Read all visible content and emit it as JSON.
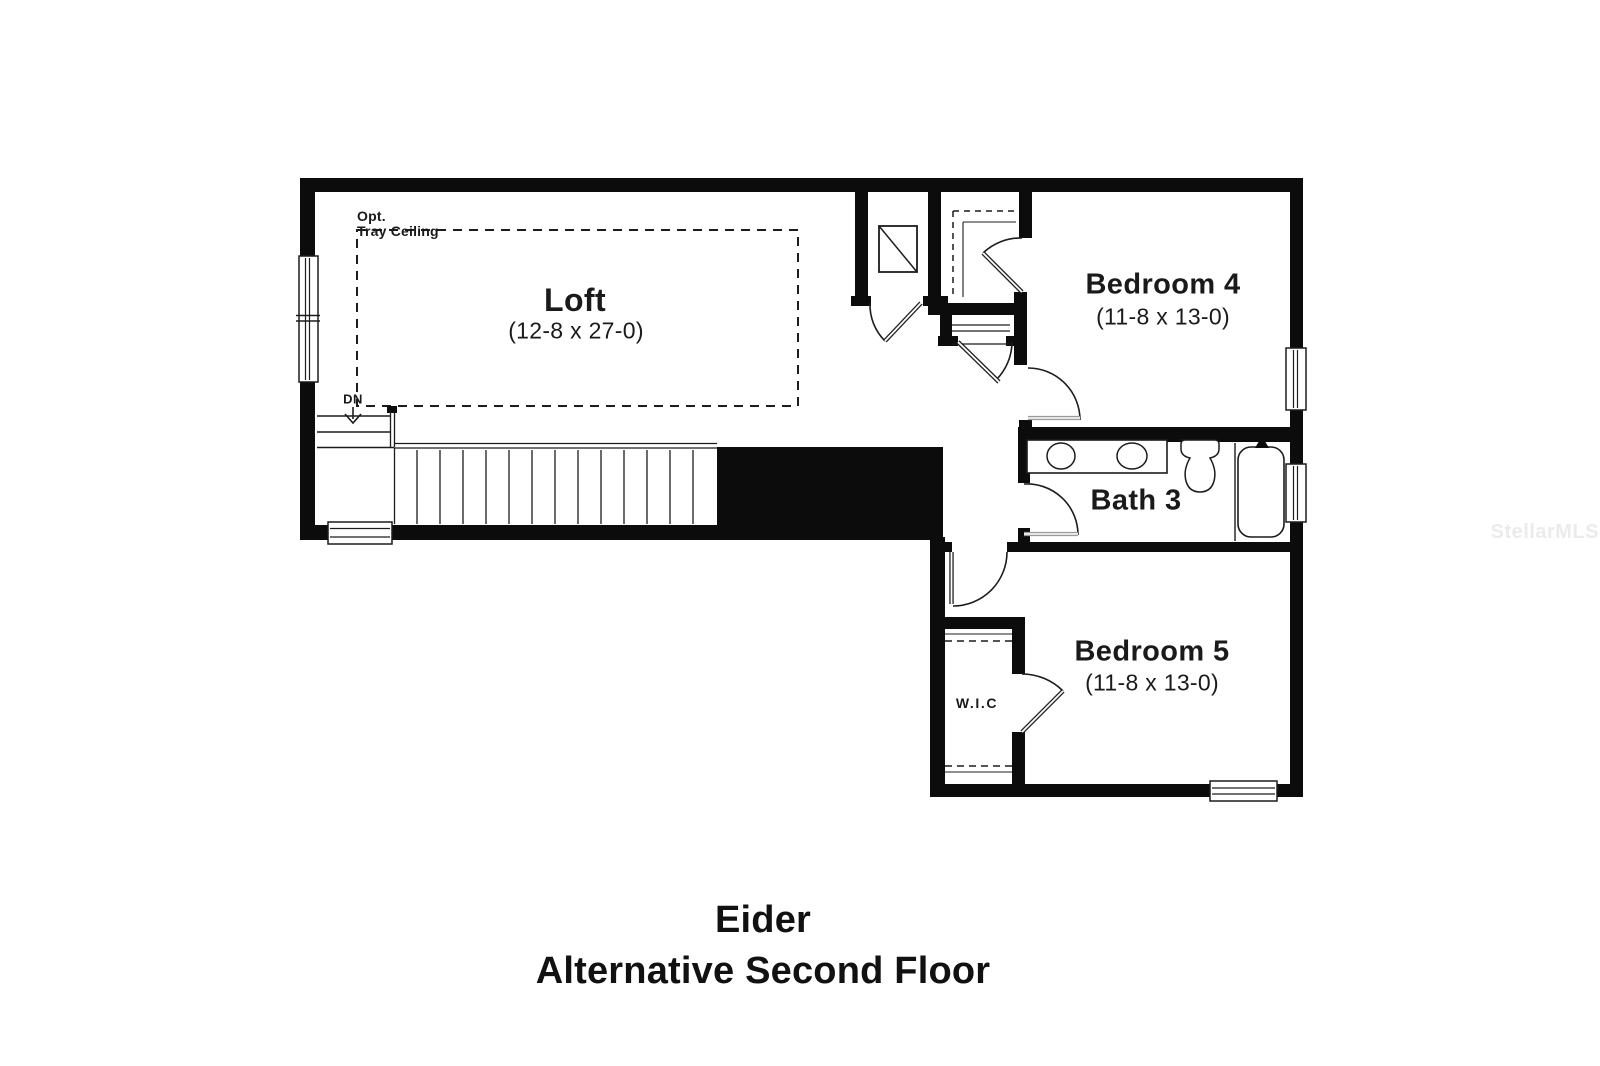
{
  "floor_plan": {
    "title": {
      "line1": "Eider",
      "line2": "Alternative Second Floor"
    },
    "watermark": "StellarMLS",
    "rooms": {
      "loft": {
        "name": "Loft",
        "dims": "(12-8 x 27-0)"
      },
      "bedroom4": {
        "name": "Bedroom 4",
        "dims": "(11-8 x 13-0)"
      },
      "bath3": {
        "name": "Bath 3"
      },
      "bedroom5": {
        "name": "Bedroom 5",
        "dims": "(11-8 x 13-0)"
      },
      "wic": {
        "name": "W.I.C"
      }
    },
    "annotations": {
      "opt": "Opt.",
      "tray_ceiling": "Tray Ceiling",
      "down": "DN"
    },
    "colors": {
      "wall": "#0c0c0c",
      "line": "#1c1c1c",
      "watermark": "#ebebeb",
      "background": "#ffffff"
    }
  }
}
